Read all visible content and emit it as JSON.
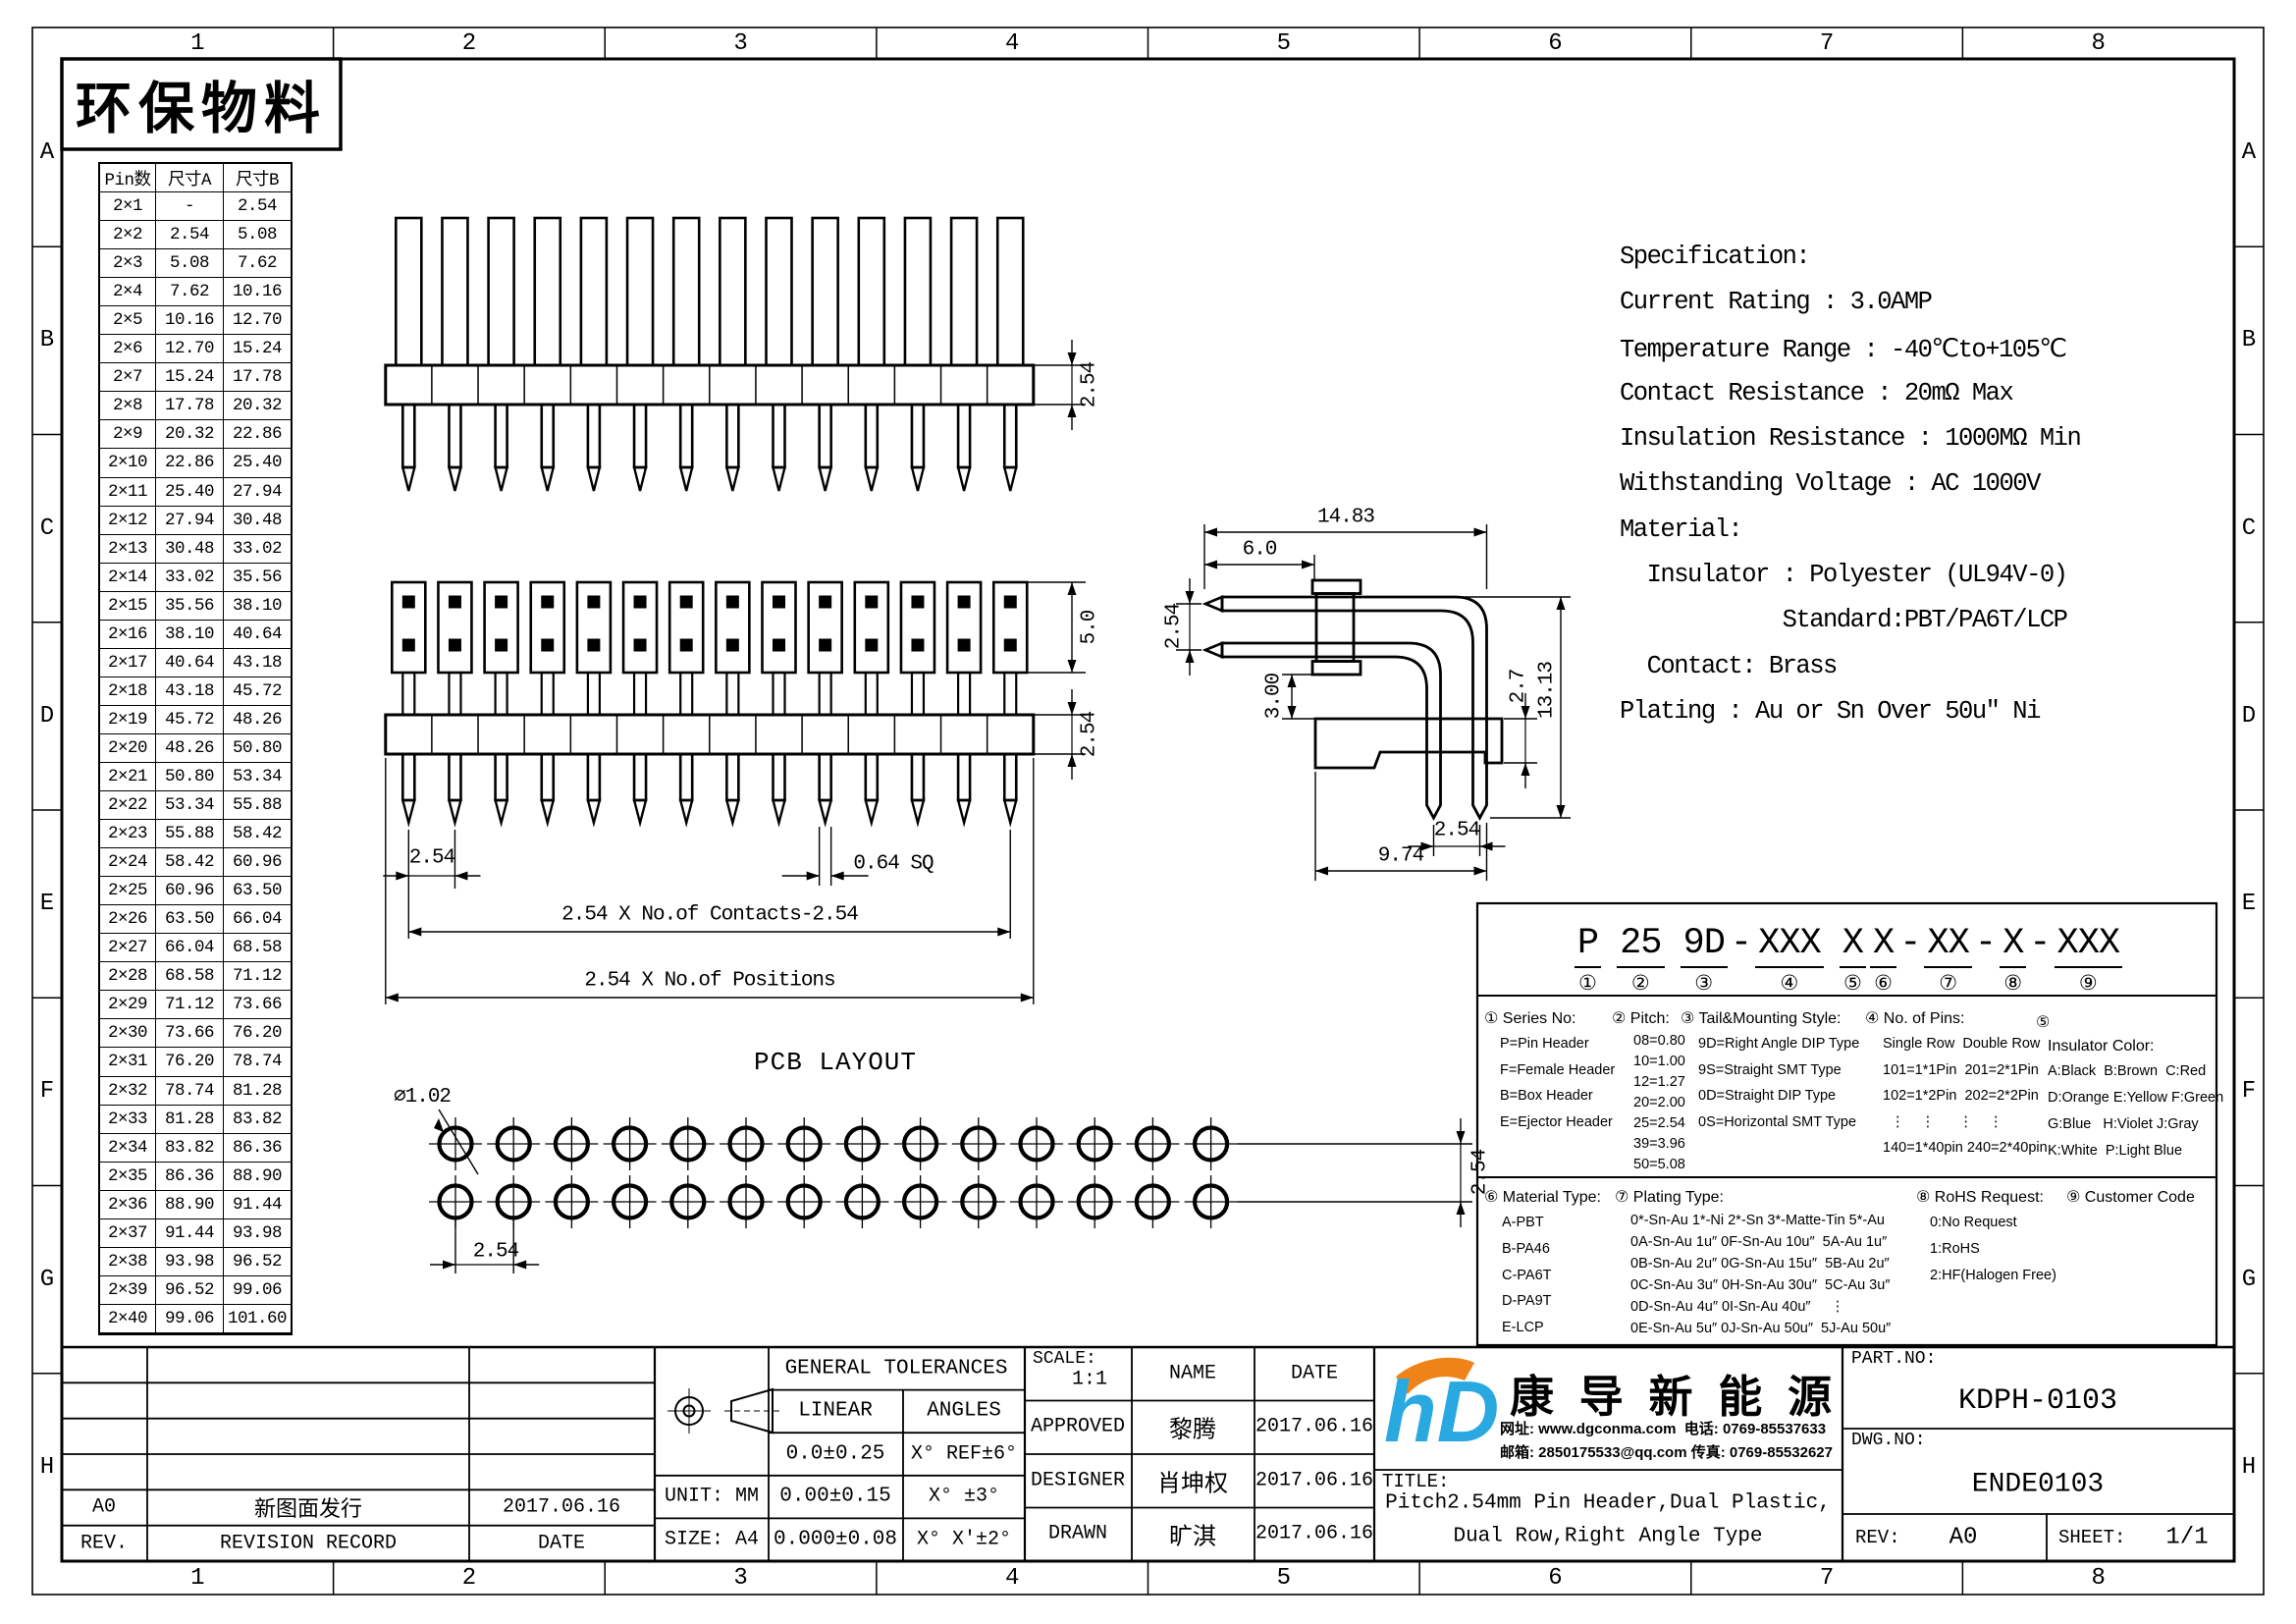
{
  "zones": {
    "cols": [
      "1",
      "2",
      "3",
      "4",
      "5",
      "6",
      "7",
      "8"
    ],
    "rows": [
      "A",
      "B",
      "C",
      "D",
      "E",
      "F",
      "G",
      "H"
    ]
  },
  "stamp": "环保物料",
  "pin_table": {
    "headers": [
      "Pin数",
      "尺寸A",
      "尺寸B"
    ],
    "rows": [
      [
        "2×1",
        "-",
        "2.54"
      ],
      [
        "2×2",
        "2.54",
        "5.08"
      ],
      [
        "2×3",
        "5.08",
        "7.62"
      ],
      [
        "2×4",
        "7.62",
        "10.16"
      ],
      [
        "2×5",
        "10.16",
        "12.70"
      ],
      [
        "2×6",
        "12.70",
        "15.24"
      ],
      [
        "2×7",
        "15.24",
        "17.78"
      ],
      [
        "2×8",
        "17.78",
        "20.32"
      ],
      [
        "2×9",
        "20.32",
        "22.86"
      ],
      [
        "2×10",
        "22.86",
        "25.40"
      ],
      [
        "2×11",
        "25.40",
        "27.94"
      ],
      [
        "2×12",
        "27.94",
        "30.48"
      ],
      [
        "2×13",
        "30.48",
        "33.02"
      ],
      [
        "2×14",
        "33.02",
        "35.56"
      ],
      [
        "2×15",
        "35.56",
        "38.10"
      ],
      [
        "2×16",
        "38.10",
        "40.64"
      ],
      [
        "2×17",
        "40.64",
        "43.18"
      ],
      [
        "2×18",
        "43.18",
        "45.72"
      ],
      [
        "2×19",
        "45.72",
        "48.26"
      ],
      [
        "2×20",
        "48.26",
        "50.80"
      ],
      [
        "2×21",
        "50.80",
        "53.34"
      ],
      [
        "2×22",
        "53.34",
        "55.88"
      ],
      [
        "2×23",
        "55.88",
        "58.42"
      ],
      [
        "2×24",
        "58.42",
        "60.96"
      ],
      [
        "2×25",
        "60.96",
        "63.50"
      ],
      [
        "2×26",
        "63.50",
        "66.04"
      ],
      [
        "2×27",
        "66.04",
        "68.58"
      ],
      [
        "2×28",
        "68.58",
        "71.12"
      ],
      [
        "2×29",
        "71.12",
        "73.66"
      ],
      [
        "2×30",
        "73.66",
        "76.20"
      ],
      [
        "2×31",
        "76.20",
        "78.74"
      ],
      [
        "2×32",
        "78.74",
        "81.28"
      ],
      [
        "2×33",
        "81.28",
        "83.82"
      ],
      [
        "2×34",
        "83.82",
        "86.36"
      ],
      [
        "2×35",
        "86.36",
        "88.90"
      ],
      [
        "2×36",
        "88.90",
        "91.44"
      ],
      [
        "2×37",
        "91.44",
        "93.98"
      ],
      [
        "2×38",
        "93.98",
        "96.52"
      ],
      [
        "2×39",
        "96.52",
        "99.06"
      ],
      [
        "2×40",
        "99.06",
        "101.60"
      ]
    ]
  },
  "spec": {
    "lines": [
      "Specification:",
      "Current Rating : 3.0AMP",
      "Temperature Range : -40℃to+105℃",
      "Contact Resistance : 20mΩ Max",
      "Insulation Resistance : 1000MΩ Min",
      "Withstanding Voltage : AC 1000V",
      "Material:",
      "  Insulator : Polyester (UL94V-0)",
      "            Standard:PBT/PA6T/LCP",
      "  Contact: Brass",
      "Plating : Au or Sn Over 50u″ Ni"
    ]
  },
  "views": {
    "positions": 14,
    "view1": {
      "dim_height": "2.54"
    },
    "view2": {
      "dim_box_h": "5.0",
      "dim_bar_h": "2.54",
      "dim_pitch": "2.54",
      "dim_pin_sq": "0.64 SQ",
      "dim_contacts": "2.54 X No.of Contacts-2.54",
      "dim_positions": "2.54 X No.of Positions"
    },
    "side": {
      "dim_width": "14.83",
      "dim_pin_len": "6.0",
      "dim_row_pitch": "2.54",
      "dim_standoff": "3.00",
      "dim_block_h": "2.7",
      "dim_height": "13.13",
      "dim_tail_pitch": "2.54",
      "dim_bottom_w": "9.74"
    },
    "pcb": {
      "title": "PCB LAYOUT",
      "hole_dia": "∅1.02",
      "dim_pitch_x": "2.54",
      "dim_pitch_y": "2.54"
    }
  },
  "part_code": {
    "segments": [
      {
        "sep": "",
        "text": "P",
        "num": "①"
      },
      {
        "sep": " ",
        "text": "25",
        "num": "②"
      },
      {
        "sep": " ",
        "text": "9D",
        "num": "③"
      },
      {
        "sep": "-",
        "text": "XXX",
        "num": "④"
      },
      {
        "sep": " ",
        "text": "X",
        "num": "⑤"
      },
      {
        "sep": "",
        "text": "X",
        "num": "⑥"
      },
      {
        "sep": "-",
        "text": "XX",
        "num": "⑦"
      },
      {
        "sep": "-",
        "text": "X",
        "num": "⑧"
      },
      {
        "sep": "-",
        "text": "XXX",
        "num": "⑨"
      }
    ]
  },
  "legend": {
    "s1": {
      "header": "① Series No:",
      "items": [
        "P=Pin Header",
        "F=Female Header",
        "B=Box Header",
        "E=Ejector Header"
      ]
    },
    "s2": {
      "header": "② Pitch:",
      "items": [
        "08=0.80",
        "10=1.00",
        "12=1.27",
        "20=2.00",
        "25=2.54",
        "39=3.96",
        "50=5.08"
      ]
    },
    "s3": {
      "header": "③ Tail&Mounting Style:",
      "items": [
        "9D=Right Angle DIP Type",
        "9S=Straight SMT Type",
        "0D=Straight DIP Type",
        "0S=Horizontal SMT Type"
      ]
    },
    "s4": {
      "header": "④ No. of Pins:",
      "items": [
        "Single Row  Double Row",
        "101=1*1Pin  201=2*1Pin",
        "102=1*2Pin  202=2*2Pin",
        "  ⋮    ⋮      ⋮    ⋮",
        "140=1*40pin 240=2*40pin"
      ]
    },
    "s5": {
      "header": "⑤",
      "subheader": "Insulator Color:",
      "items": [
        "A:Black  B:Brown  C:Red",
        "D:Orange E:Yellow F:Green",
        "G:Blue   H:Violet J:Gray",
        "K:White  P:Light Blue"
      ]
    },
    "s6": {
      "header": "⑥ Material Type:",
      "items": [
        "A-PBT",
        "B-PA46",
        "C-PA6T",
        "D-PA9T",
        "E-LCP"
      ]
    },
    "s7": {
      "header": "⑦ Plating Type:",
      "items": [
        "0*-Sn-Au 1*-Ni 2*-Sn 3*-Matte-Tin 5*-Au",
        "0A-Sn-Au 1u″ 0F-Sn-Au 10u″  5A-Au 1u″",
        "0B-Sn-Au 2u″ 0G-Sn-Au 15u″  5B-Au 2u″",
        "0C-Sn-Au 3u″ 0H-Sn-Au 30u″  5C-Au 3u″",
        "0D-Sn-Au 4u″ 0I-Sn-Au 40u″     ⋮",
        "0E-Sn-Au 5u″ 0J-Sn-Au 50u″  5J-Au 50u″"
      ]
    },
    "s8": {
      "header": "⑧ RoHS Request:",
      "items": [
        "0:No Request",
        "1:RoHS",
        "2:HF(Halogen Free)"
      ]
    },
    "s9": {
      "header": "⑨ Customer Code",
      "items": []
    }
  },
  "title_block": {
    "revision": {
      "rev": "A0",
      "desc": "新图面发行",
      "date": "2017.06.16",
      "footer_rev": "REV.",
      "footer_desc": "REVISION RECORD",
      "footer_date": "DATE"
    },
    "tolerances": {
      "header": "GENERAL TOLERANCES",
      "linear_label": "LINEAR",
      "angles_label": "ANGLES",
      "unit": "UNIT: MM",
      "size": "SIZE: A4",
      "linear_rows": [
        "0.0±0.25",
        "0.00±0.15",
        "0.000±0.08"
      ],
      "angle_rows": [
        "X° REF±6°",
        "X° ±3°",
        "X° X'±2°"
      ]
    },
    "approval": {
      "scale_label": "SCALE:",
      "scale": "1:1",
      "name_label": "NAME",
      "date_label": "DATE",
      "approved_label": "APPROVED",
      "approved": "黎腾",
      "approved_date": "2017.06.16",
      "designer_label": "DESIGNER",
      "designer": "肖坤权",
      "designer_date": "2017.06.16",
      "drawn_label": "DRAWN",
      "drawn": "旷淇",
      "drawn_date": "2017.06.16"
    },
    "company": {
      "logo_text": "hD",
      "name": "康导新能源",
      "contact1": "网址: www.dgconma.com  电话: 0769-85537633",
      "contact2": "邮箱: 2850175533@qq.com 传真: 0769-85532627"
    },
    "title_label": "TITLE:",
    "title_line1": "Pitch2.54mm Pin Header,Dual Plastic,",
    "title_line2": "Dual Row,Right Angle Type",
    "part_no_label": "PART.NO:",
    "part_no": "KDPH-0103",
    "dwg_no_label": "DWG.NO:",
    "dwg_no": "ENDE0103",
    "rev_label": "REV:",
    "rev": "A0",
    "sheet_label": "SHEET:",
    "sheet": "1/1"
  },
  "colors": {
    "logo_blue": "#29A9E0",
    "logo_orange": "#F08318",
    "line": "#000000"
  }
}
